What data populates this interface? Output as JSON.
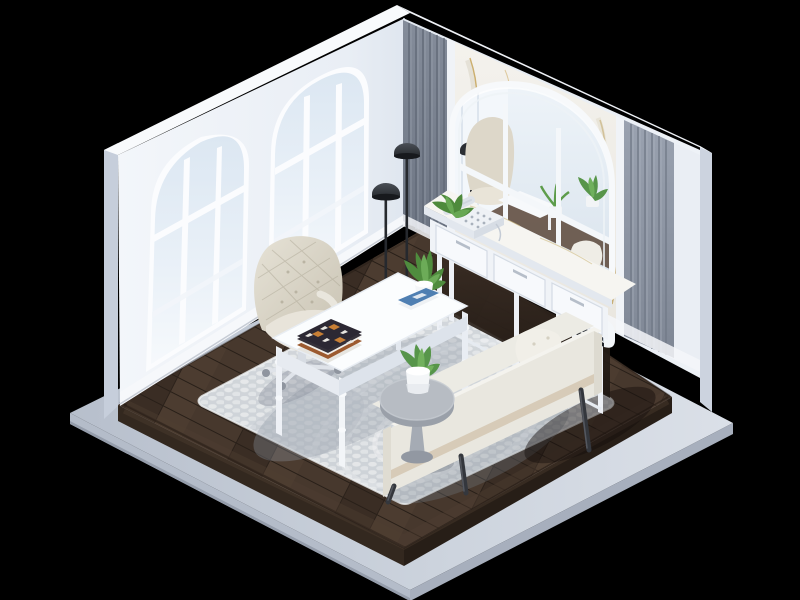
{
  "meta": {
    "description": "Isometric low-poly 3D render of a bright home office diorama on a floating platform, black background",
    "canvas": {
      "width": 800,
      "height": 600
    }
  },
  "background": "#000000",
  "palette": {
    "background": "#000000",
    "wallWhite": "#eef2f7",
    "wallTopBand": "#f7f9fc",
    "wallOuterSide": "#c9d1de",
    "glassBlue": "#e3ecf5",
    "frameWhite": "#fbfcfe",
    "slatGrayCorner": "#79818f",
    "slatGrayRight": "#8f97a5",
    "marbleWhite": "#f1efe9",
    "marbleVeinGold": "#c29a42",
    "mirrorSky": "#e6eef6",
    "woodFloorTop": "#41332a",
    "woodFloorSide": "#2c221b",
    "platformTop": "#c9d0da",
    "platformSide": "#aeb6c4",
    "rugBase": "#d6dade",
    "rugDot": "#eaeceE",
    "deskWhite": "#fafcfd",
    "chairBeige": "#d8d2c4",
    "sofaCream": "#e9e7df",
    "sofaStripe": "#d7cbb8",
    "legDark": "#34373d",
    "lampBlack": "#26292e",
    "tableGray": "#b4bac2",
    "plantGreen": "#5d9c4a",
    "potWhite": "#f4f6f8",
    "bookOrange": "#b06a35",
    "bookNavy": "#2c2833",
    "bookBlue": "#4f7fb2",
    "phoneWhite": "#eef1f5",
    "shelfBookDark": "#24272c"
  },
  "scene": {
    "style": "isometric 3D room render",
    "room_type": "home office",
    "objects": [
      {
        "name": "platform-base",
        "description": "light gray floating slab base"
      },
      {
        "name": "dark-wood-floor",
        "description": "dark walnut plank floor with border"
      },
      {
        "name": "left-wall",
        "description": "white wall with two tall arched windows"
      },
      {
        "name": "right-wall",
        "description": "gray vertical slat panels and white marble panel"
      },
      {
        "name": "arched-mirror",
        "description": "large arched paned mirror reflecting the room"
      },
      {
        "name": "console-vanity",
        "description": "white marble-top console with three drawers and book shelf"
      },
      {
        "name": "vintage-telephone",
        "description": "white retro telephone on console"
      },
      {
        "name": "floor-lamps",
        "description": "two black dome floor lamps in the corner"
      },
      {
        "name": "writing-desk",
        "description": "white desk with turned legs"
      },
      {
        "name": "book-stack",
        "description": "patterned books on desk"
      },
      {
        "name": "desk-plant",
        "description": "aloe in white pot"
      },
      {
        "name": "office-chair",
        "description": "beige tufted swivel chair on casters"
      },
      {
        "name": "area-rug",
        "description": "light gray pebble mosaic rug"
      },
      {
        "name": "bench-sofa",
        "description": "cream bench sofa with dark splayed legs and tufted pillow"
      },
      {
        "name": "side-table-round",
        "description": "round gray pedestal table with succulent"
      }
    ]
  }
}
